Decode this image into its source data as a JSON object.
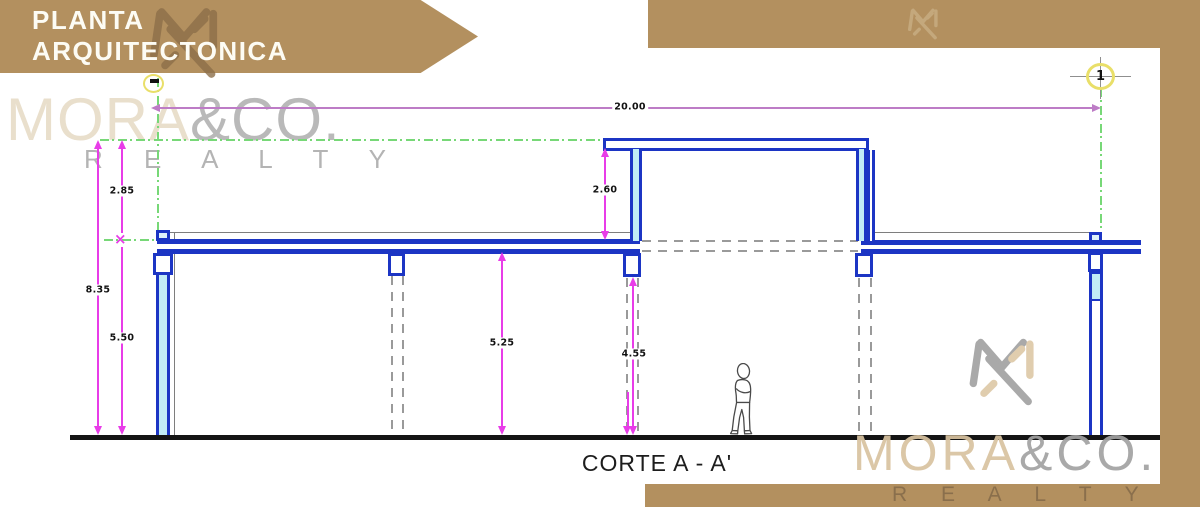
{
  "banner": {
    "line1": "PLANTA",
    "line2": "ARQUITECTONICA"
  },
  "logo_top_left": {
    "brand": "MORA",
    "suffix": "&CO.",
    "tagline": "R E A L T Y"
  },
  "logo_bottom_right": {
    "brand": "MORA",
    "suffix": "&CO.",
    "tagline": "R E A L T Y"
  },
  "drawing": {
    "title": "CORTE A - A'",
    "grid_bubble_label": "1",
    "dimensions": {
      "overall_width": "20.00",
      "overall_height": "8.35",
      "roof_upper_band": "2.85",
      "floor_to_roof": "5.50",
      "clerestory_height": "2.60",
      "clear_height_slab": "5.25",
      "clear_height_beam": "4.55"
    },
    "colors": {
      "walls_blue": "#1c35c4",
      "glazing_cyan": "#c2ecf6",
      "dimension_magenta": "#e83ce8",
      "axis_green": "#77d877",
      "hidden_gray": "#9a9a9a",
      "brand_brown": "#b3905f"
    }
  }
}
